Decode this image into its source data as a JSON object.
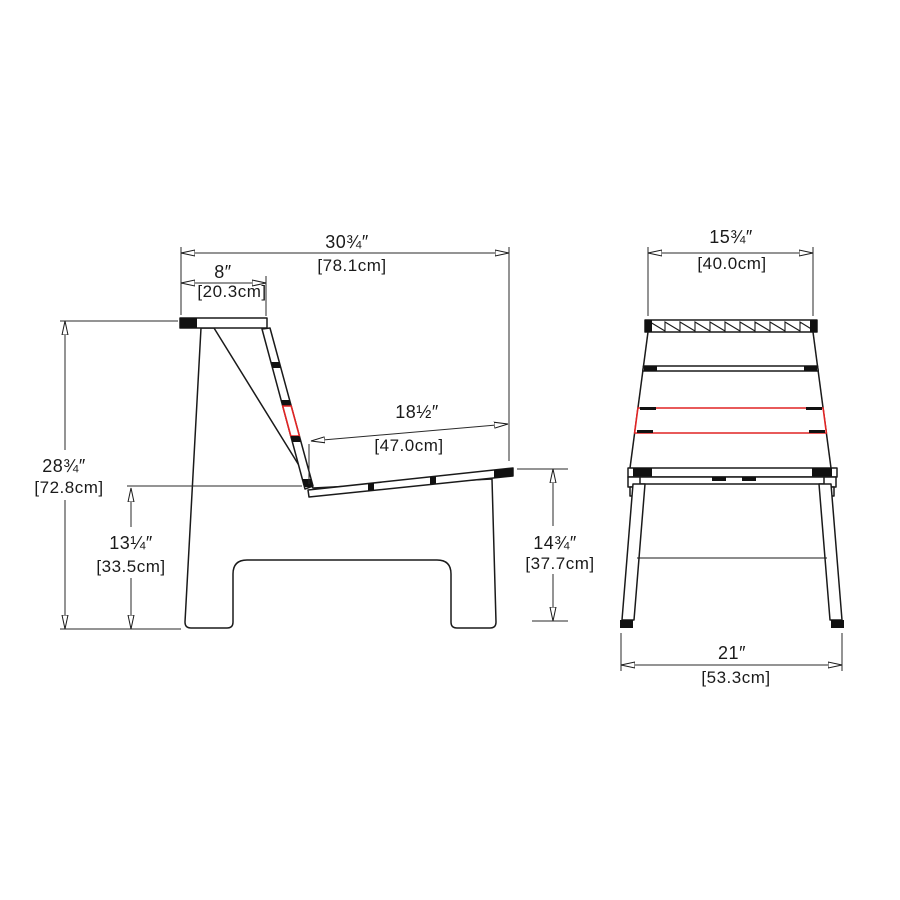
{
  "colors": {
    "highlight_red": "#e02424",
    "ink": "#1a1a1a"
  },
  "side_view": {
    "overall_width": {
      "in": "30¾″",
      "cm": "[78.1cm]"
    },
    "back_top_width": {
      "in": "8″",
      "cm": "[20.3cm]"
    },
    "seat_depth": {
      "in": "18½″",
      "cm": "[47.0cm]"
    },
    "overall_height": {
      "in": "28¾″",
      "cm": "[72.8cm]"
    },
    "seat_height_rear": {
      "in": "13¼″",
      "cm": "[33.5cm]"
    },
    "seat_height_front": {
      "in": "14¾″",
      "cm": "[37.7cm]"
    }
  },
  "front_view": {
    "back_width": {
      "in": "15¾″",
      "cm": "[40.0cm]"
    },
    "base_width": {
      "in": "21″",
      "cm": "[53.3cm]"
    }
  }
}
